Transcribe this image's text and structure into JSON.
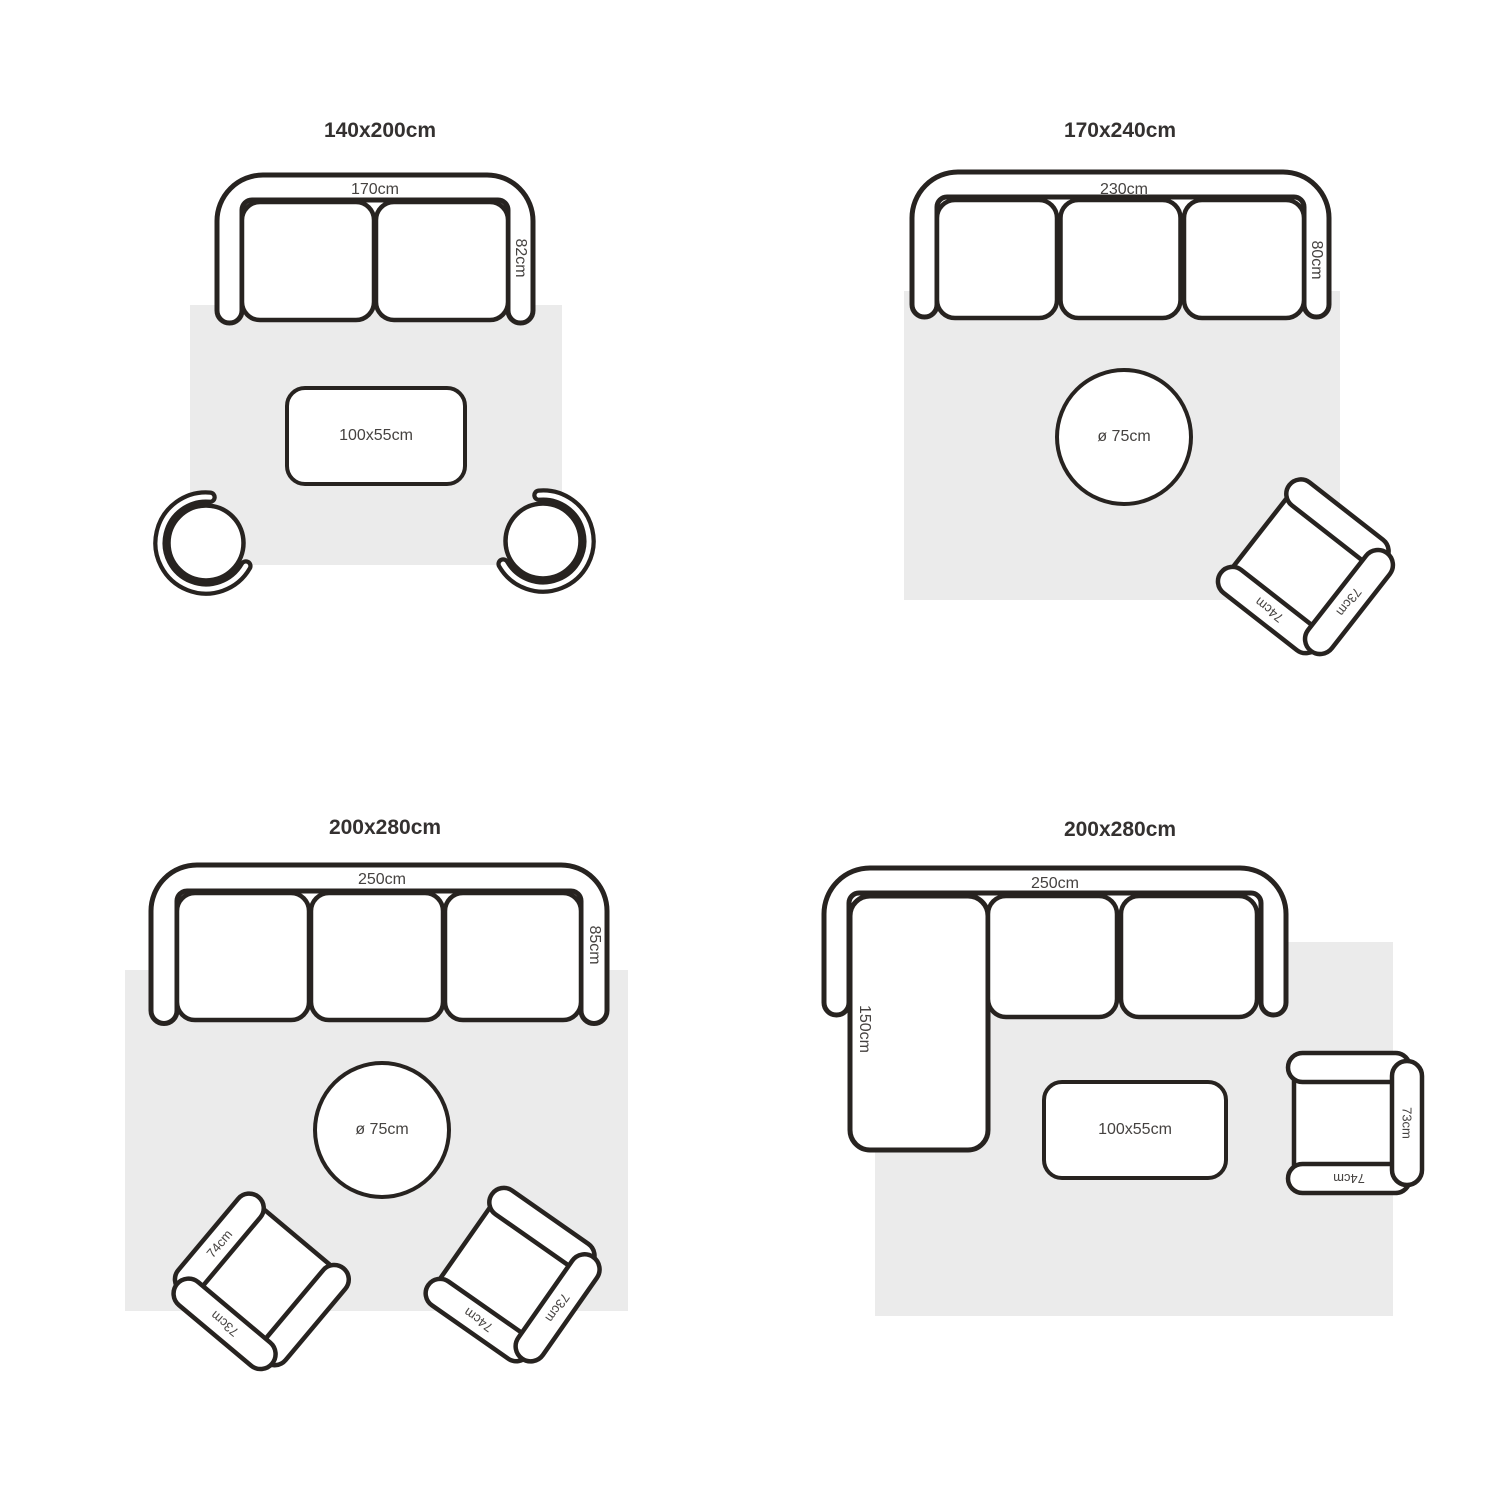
{
  "palette": {
    "line": "#272320",
    "rug": "#ebebeb",
    "label": "#454240",
    "title": "#343130",
    "fill": "#ffffff"
  },
  "quadrants": {
    "q1": {
      "title": "140x200cm",
      "sofa": {
        "seats": 2,
        "width_label": "170cm",
        "depth_label": "82cm"
      },
      "table": {
        "shape": "rectangle",
        "label": "100x55cm"
      },
      "stools": 2
    },
    "q2": {
      "title": "170x240cm",
      "sofa": {
        "seats": 3,
        "width_label": "230cm",
        "depth_label": "80cm"
      },
      "table": {
        "shape": "round",
        "label": "ø 75cm"
      },
      "armchair": {
        "arm_label": "74cm",
        "back_label": "73cm"
      }
    },
    "q3": {
      "title": "200x280cm",
      "sofa": {
        "seats": 3,
        "width_label": "250cm",
        "depth_label": "85cm"
      },
      "table": {
        "shape": "round",
        "label": "ø 75cm"
      },
      "armchair_left": {
        "arm_label": "74cm",
        "back_label": "73cm"
      },
      "armchair_right": {
        "arm_label": "74cm",
        "back_label": "73cm"
      }
    },
    "q4": {
      "title": "200x280cm",
      "sofa": {
        "seats": 2,
        "width_label": "250cm",
        "chaise_label": "150cm"
      },
      "table": {
        "shape": "rectangle",
        "label": "100x55cm"
      },
      "armchair": {
        "arm_label": "74cm",
        "back_label": "73cm"
      }
    }
  }
}
